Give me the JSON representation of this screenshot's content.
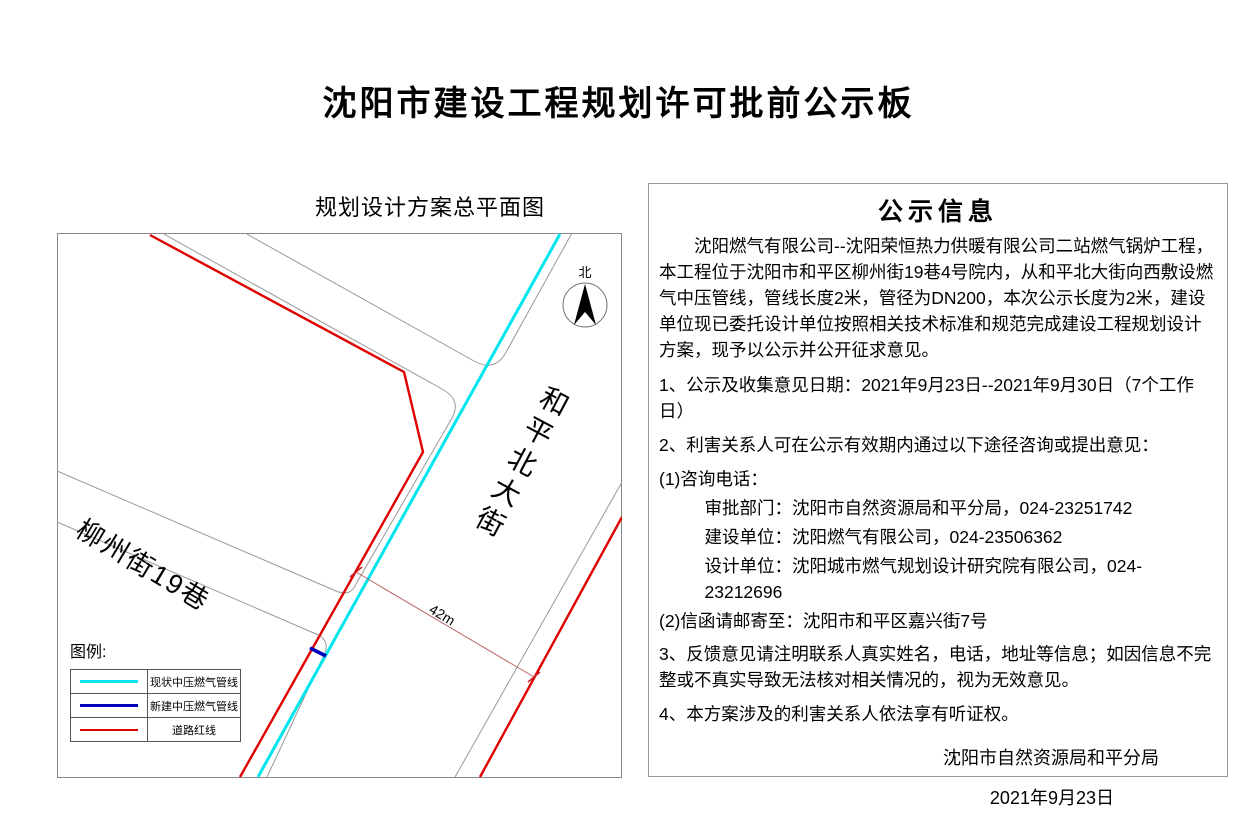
{
  "page_title": "沈阳市建设工程规划许可批前公示板",
  "map": {
    "title": "规划设计方案总平面图",
    "north_label": "北",
    "street_vertical": "和平北大街",
    "street_diagonal": "柳州街19巷",
    "dimension_label": "42m",
    "dimension_line_color": "#bb6666",
    "legend": {
      "title": "图例:",
      "items": [
        {
          "label": "现状中压燃气管线",
          "color": "#00e5ee"
        },
        {
          "label": "新建中压燃气管线",
          "color": "#0000bb"
        },
        {
          "label": "道路红线",
          "color": "#e00000"
        }
      ]
    }
  },
  "notice": {
    "title": "公示信息",
    "intro": "沈阳燃气有限公司--沈阳荣恒热力供暖有限公司二站燃气锅炉工程，本工程位于沈阳市和平区柳州街19巷4号院内，从和平北大街向西敷设燃气中压管线，管线长度2米，管径为DN200，本次公示长度为2米，建设单位现已委托设计单位按照相关技术标准和规范完成建设工程规划设计方案，现予以公示并公开征求意见。",
    "item1": "1、公示及收集意见日期：2021年9月23日--2021年9月30日（7个工作日）",
    "item2": "2、利害关系人可在公示有效期内通过以下途径咨询或提出意见：",
    "phone_header": "(1)咨询电话：",
    "phone_lines": [
      "审批部门：沈阳市自然资源局和平分局，024-23251742",
      "建设单位：沈阳燃气有限公司，024-23506362",
      "设计单位：沈阳城市燃气规划设计研究院有限公司，024-23212696"
    ],
    "mail_line": "(2)信函请邮寄至：沈阳市和平区嘉兴街7号",
    "item3": "3、反馈意见请注明联系人真实姓名，电话，地址等信息；如因信息不完整或不真实导致无法核对相关情况的，视为无效意见。",
    "item4": "4、本方案涉及的利害关系人依法享有听证权。",
    "signature": "沈阳市自然资源局和平分局",
    "date": "2021年9月23日"
  }
}
